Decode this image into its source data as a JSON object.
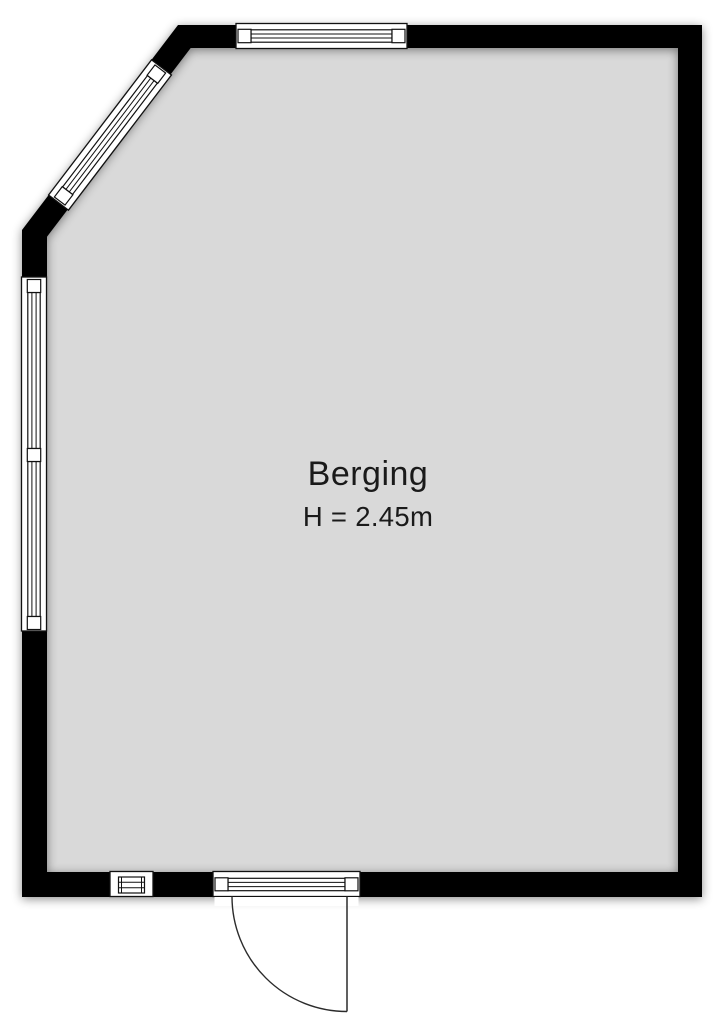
{
  "room": {
    "name": "Berging",
    "height_label": "H = 2.45m"
  },
  "colors": {
    "background": "#ffffff",
    "floor": "#d9d9d9",
    "wall": "#000000",
    "outline": "#111111",
    "text": "#1a1a1a"
  }
}
